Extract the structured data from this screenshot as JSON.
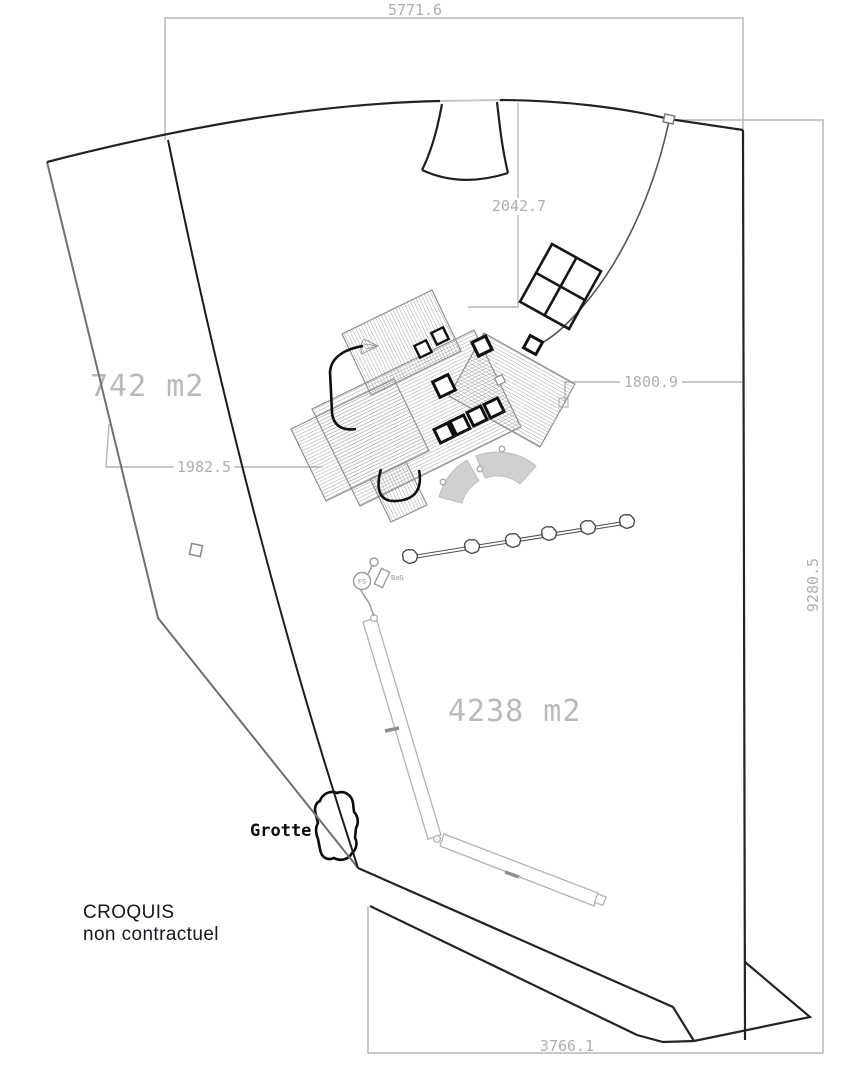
{
  "drawing": {
    "dimensions": {
      "top": "5771.6",
      "right": "9280.5",
      "bottom": "3766.1",
      "north_access": "2042.7",
      "east_house": "1800.9",
      "west_house": "1982.5"
    },
    "areas": {
      "left_parcel": "742 m2",
      "main_parcel": "4238 m2"
    },
    "labels": {
      "grotto": "Grotte",
      "note_line1": "CROQUIS",
      "note_line2": "non contractuel",
      "manhole": "FS",
      "utility": "BaG"
    },
    "colors": {
      "dimension_gray": "#aeaeae",
      "area_text_gray": "#b9b9b9",
      "boundary_black": "#232323",
      "left_boundary_gray": "#707070",
      "roof_hatch_gray": "#9c9c9c",
      "note_text": "#17171f"
    }
  }
}
